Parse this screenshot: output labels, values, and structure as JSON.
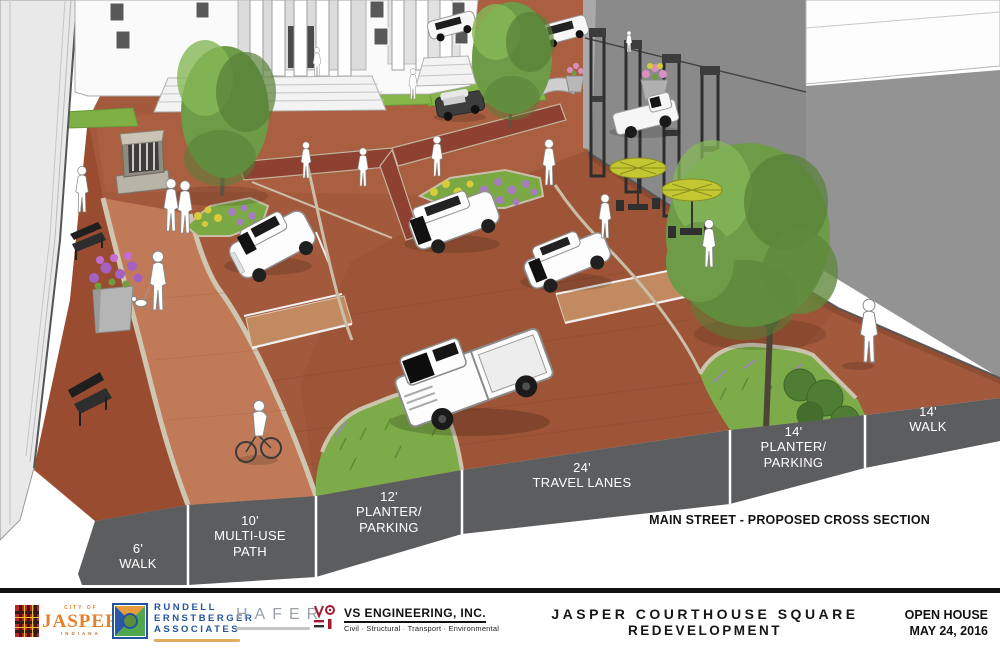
{
  "cross_section": {
    "bands": [
      {
        "lines": [
          "6'",
          "WALK"
        ]
      },
      {
        "lines": [
          "10'",
          "MULTI-USE",
          "PATH"
        ]
      },
      {
        "lines": [
          "12'",
          "PLANTER/",
          "PARKING"
        ]
      },
      {
        "lines": [
          "24'",
          "TRAVEL LANES"
        ]
      },
      {
        "lines": [
          "14'",
          "PLANTER/",
          "PARKING"
        ]
      },
      {
        "lines": [
          "14'",
          "WALK"
        ]
      }
    ],
    "caption": "MAIN STREET - PROPOSED CROSS SECTION"
  },
  "footer": {
    "jasper": {
      "city_of": "CITY OF",
      "name": "JASPER",
      "state": "INDIANA"
    },
    "rea": {
      "line1": "RUNDELL",
      "line2": "ERNSTBERGER",
      "line3": "ASSOCIATES"
    },
    "hafer": {
      "name": "HAFER"
    },
    "vs": {
      "name": "VS ENGINEERING, INC.",
      "tagline": "Civil · Structural · Transport · Environmental"
    },
    "title_line1": "JASPER COURTHOUSE SQUARE",
    "title_line2": "REDEVELOPMENT",
    "event_line1": "OPEN HOUSE",
    "event_line2": "MAY 24, 2016"
  },
  "colors": {
    "band_gray": "#5c5d5f",
    "brick": "#a3593c",
    "path_salmon": "#c07a58",
    "grass": "#7dab49",
    "umbrella_yellow": "#c3c832",
    "jasper_orange": "#e87f2b",
    "rea_blue": "#24549e",
    "vs_red": "#a6192e",
    "footer_bar": "#111111"
  }
}
